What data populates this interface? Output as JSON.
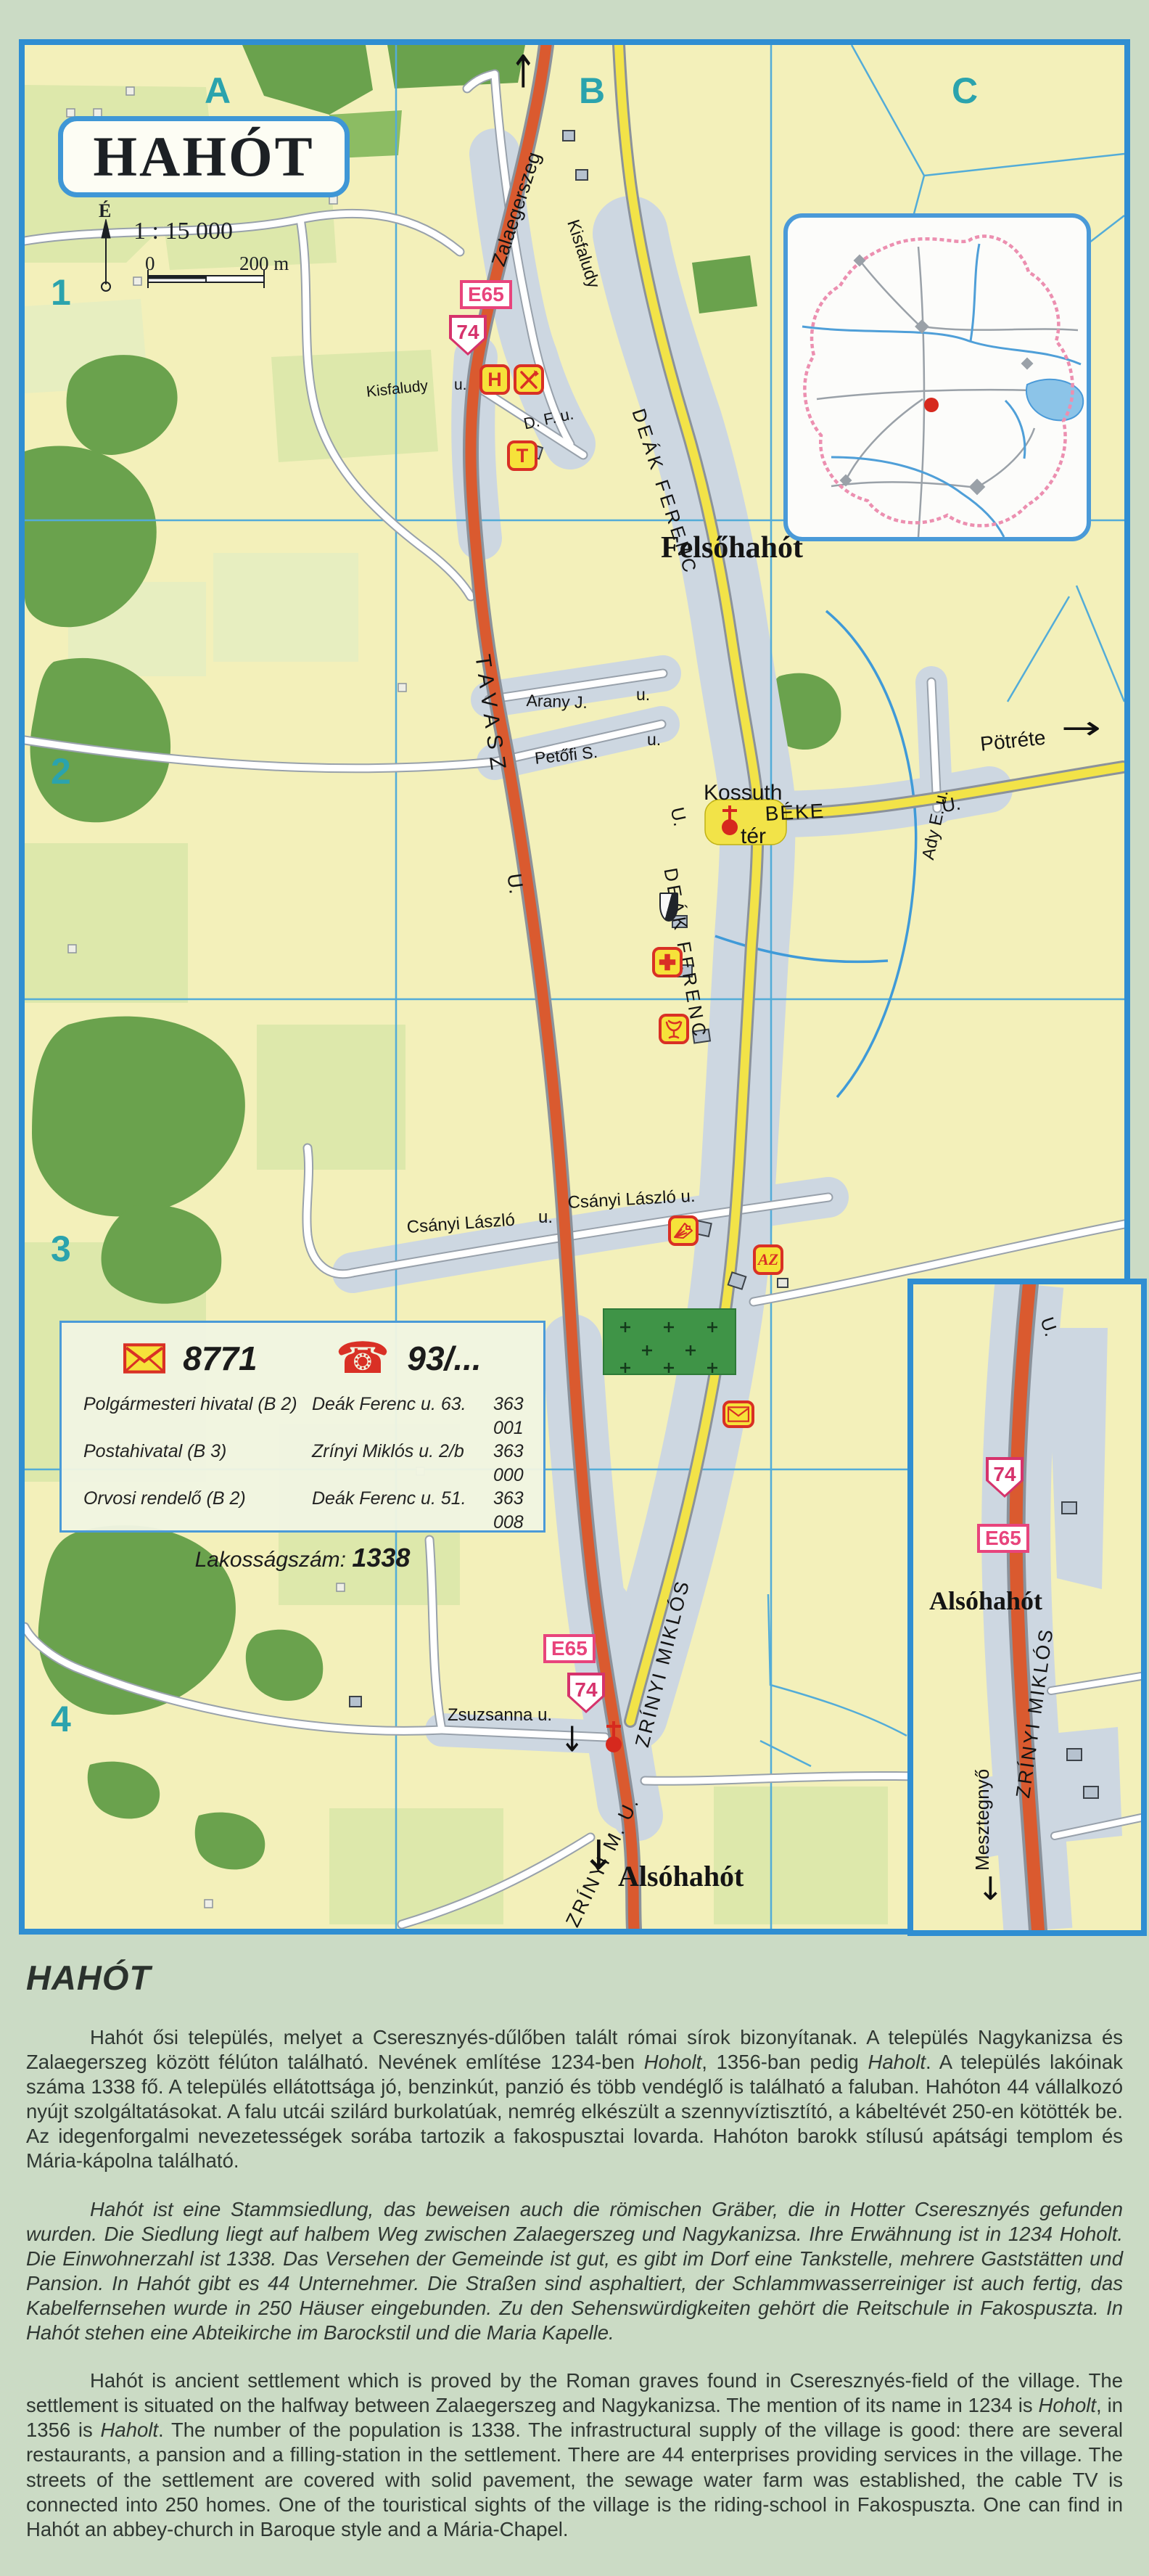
{
  "map": {
    "title": "HAHÓT",
    "scale": {
      "ratio": "1 : 15 000",
      "zero": "0",
      "end": "200 m",
      "north": "É"
    },
    "grid": {
      "cols": [
        "A",
        "B",
        "C"
      ],
      "rows": [
        "1",
        "2",
        "3",
        "4"
      ]
    },
    "shields": {
      "e65": "E65",
      "n74": "74"
    },
    "settlements": {
      "felso": "Felsőhahót",
      "also": "Alsóhahót"
    },
    "streets": {
      "zalaegerszeg": "Zalaegerszeg",
      "kisfaludy": "Kisfaludy",
      "u_low": "u.",
      "u_cap": "U.",
      "dfu": "D. F. u.",
      "deak": "DEÁK FERENC",
      "tavasz": "TAVASZ",
      "arany": "Arany J.",
      "petofi": "Petőfi S.",
      "kossuth": "Kossuth",
      "kossuth_ter": "tér",
      "beke": "BÉKE",
      "ady": "Ady E. u.",
      "potrete": "Pötréte",
      "csanyi": "Csányi László",
      "csanyi_full": "Csányi László u.",
      "zsuzsanna": "Zsuzsanna u.",
      "zrinyi": "ZRÍNYI MIKLÓS",
      "zrinyi_mu": "ZRÍNYI M. U.",
      "mesztegnyo": "Mesztegnyő"
    },
    "poi": {
      "hotel": "H",
      "phone_box": "T",
      "az": "AZ"
    },
    "infobox": {
      "postal_code": "8771",
      "phone_prefix": "93/...",
      "rows": [
        {
          "name": "Polgármesteri hivatal (B 2)",
          "address": "Deák Ferenc u. 63.",
          "phone": "363 001"
        },
        {
          "name": "Postahivatal (B 3)",
          "address": "Zrínyi Miklós u. 2/b",
          "phone": "363 000"
        },
        {
          "name": "Orvosi rendelő (B 2)",
          "address": "Deák Ferenc u. 51.",
          "phone": "363 008"
        }
      ],
      "population_label": "Lakosságszám:",
      "population_value": "1338"
    }
  },
  "article": {
    "heading": "HAHÓT",
    "paragraphs": [
      {
        "lang": "hu",
        "italic_all": false,
        "segments": [
          {
            "text": "Hahót ősi település, melyet a Cseresznyés-dűlőben talált római sírok bizonyítanak. A település Nagykanizsa és Zalaegerszeg között félúton található.  Nevének említése 1234-ben ",
            "italic": false
          },
          {
            "text": "Hoholt",
            "italic": true
          },
          {
            "text": ", 1356-ban pedig ",
            "italic": false
          },
          {
            "text": "Haholt",
            "italic": true
          },
          {
            "text": ". A település lakóinak száma 1338 fő. A település ellátottsága jó, benzinkút, panzió és több vendéglő is található a faluban. Hahóton 44 vállalkozó nyújt szolgáltatásokat. A falu utcái szilárd burkolatúak, nemrég elkészült a szennyvíztisztító, a kábeltévét 250-en kötötték be. Az idegenforgalmi nevezetességek sorába tartozik a fakospusztai lovarda. Hahóton barokk stílusú apátsági templom és Mária-kápolna található.",
            "italic": false
          }
        ]
      },
      {
        "lang": "de",
        "italic_all": true,
        "segments": [
          {
            "text": "Hahót ist eine Stammsiedlung, das beweisen auch die römischen Gräber, die in Hotter Cseresznyés gefunden wurden. Die Siedlung liegt auf  halbem Weg zwischen Zalaegerszeg und Nagykanizsa. Ihre Erwähnung ist in 1234 Hoholt. Die Einwohnerzahl ist 1338. Das Versehen der Gemeinde ist gut, es gibt im Dorf  eine Tankstelle, mehrere Gaststätten und Pansion. In Hahót gibt es 44 Unternehmer. Die Straßen sind asphaltiert, der Schlammwasserreiniger ist auch fertig, das Kabelfernsehen wurde in 250 Häuser eingebunden. Zu den Sehenswürdigkeiten gehört die Reitschule in Fakospuszta. In Hahót stehen eine Abteikirche im Barockstil und die Maria Kapelle.",
            "italic": false
          }
        ]
      },
      {
        "lang": "en",
        "italic_all": false,
        "segments": [
          {
            "text": "Hahót is ancient settlement which is proved by the Roman graves found in Cseresznyés-field of the village. The settlement is situated on the halfway between Zalaegerszeg and Nagykanizsa. The mention of its name in 1234 is ",
            "italic": false
          },
          {
            "text": "Hoholt",
            "italic": true
          },
          {
            "text": ", in 1356 is ",
            "italic": false
          },
          {
            "text": "Haholt",
            "italic": true
          },
          {
            "text": ". The number of the population is 1338. The infrastructural supply of the village is good: there are several restaurants, a pansion and a filling-station in the settlement. There are 44 enterprises providing services in the village. The streets of the settlement are covered with solid pavement, the sewage water farm was established, the cable TV is connected into 250 homes. One of the touristical sights of the village is the riding-school in Fakospuszta. One can find in Hahót an abbey-church in Baroque style and a Mária-Chapel.",
            "italic": false
          }
        ]
      }
    ]
  }
}
